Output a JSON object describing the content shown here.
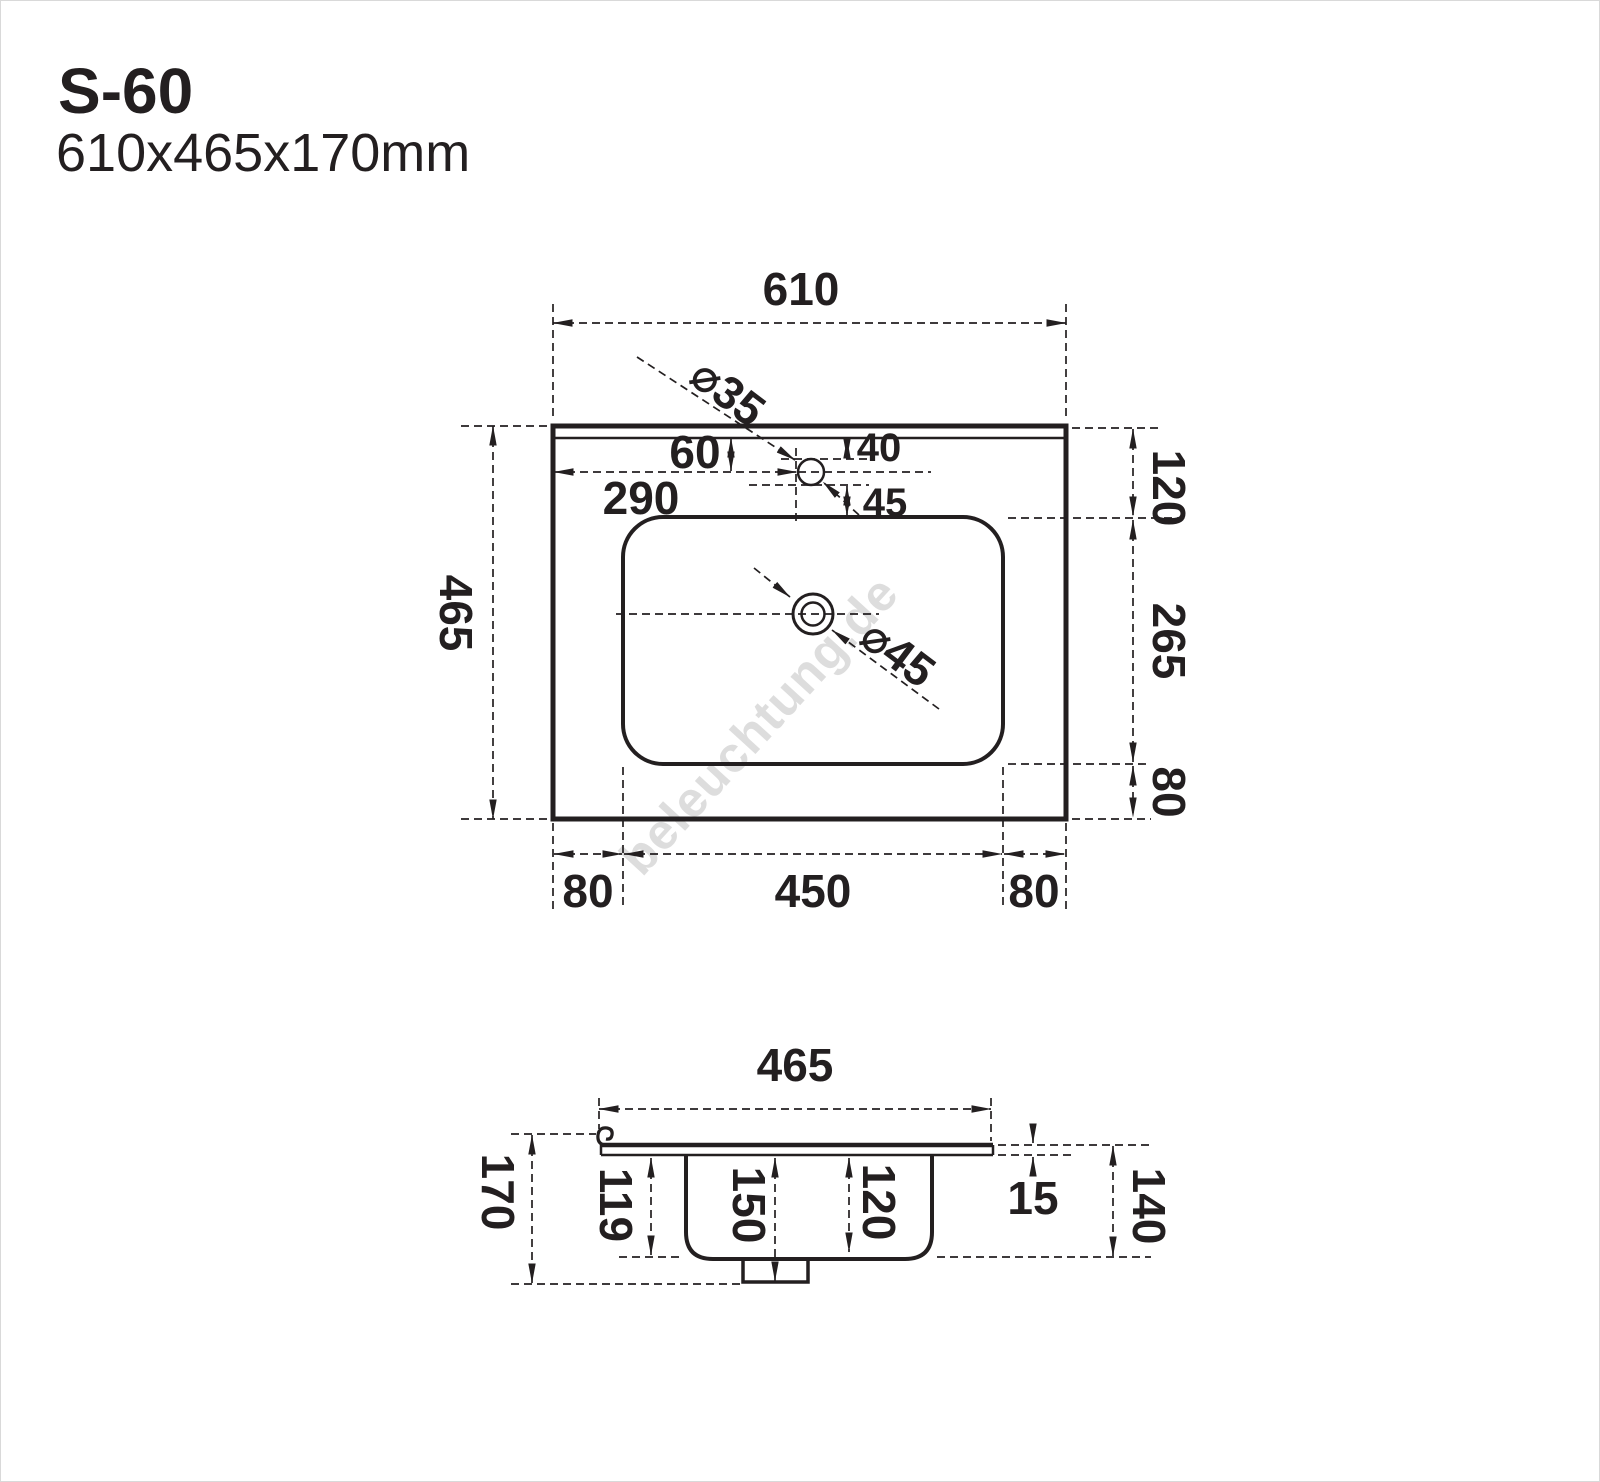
{
  "title": {
    "model": "S-60",
    "size": "610x465x170mm"
  },
  "watermark": "beleuchtung.de",
  "top_view": {
    "overall_width": "610",
    "overall_depth": "465",
    "back_edge_to_basin": "120",
    "basin_depth": "265",
    "basin_to_front_edge": "80",
    "left_margin": "80",
    "basin_width": "450",
    "right_margin": "80",
    "faucet_from_back": "60",
    "faucet_from_left": "290",
    "faucet_gap_above": "40",
    "faucet_gap_below": "45",
    "faucet_hole_diameter": "⌀35",
    "drain_diameter": "⌀45"
  },
  "side_view": {
    "overall_width": "465",
    "overall_height": "170",
    "bowl_depth_left": "119",
    "depth_to_drain": "150",
    "bowl_inner_depth": "120",
    "top_thickness": "15",
    "height_right": "140"
  }
}
